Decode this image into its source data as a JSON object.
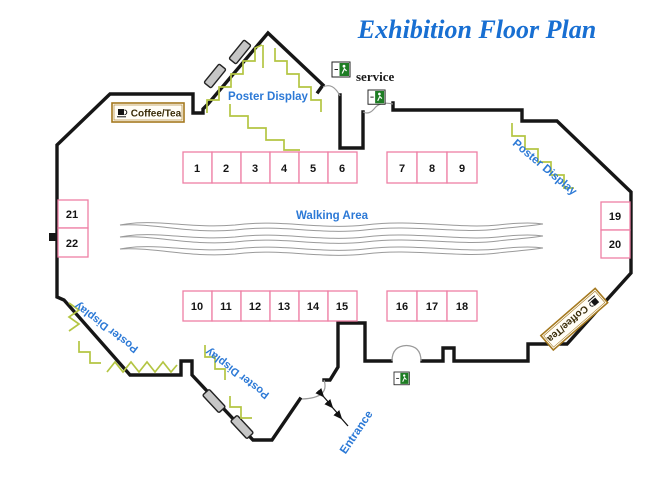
{
  "title": "Exhibition Floor Plan",
  "labels": {
    "coffee_tea_top": "Coffee/Tea",
    "coffee_tea_right": "Coffee/Tea",
    "poster_display_top": "Poster Display",
    "poster_display_right": "Poster Display",
    "poster_display_bottom_left": "Poster Display",
    "poster_display_bottom_center": "Poster Display",
    "service": "service",
    "walking_area": "Walking Area",
    "entrance": "Entrance"
  },
  "booths": {
    "top_row_left": [
      "1",
      "2",
      "3",
      "4",
      "5",
      "6"
    ],
    "top_row_right": [
      "7",
      "8",
      "9"
    ],
    "bottom_row_left": [
      "10",
      "11",
      "12",
      "13",
      "14",
      "15"
    ],
    "bottom_row_right": [
      "16",
      "17",
      "18"
    ],
    "right_wall": [
      "19",
      "20"
    ],
    "left_wall": [
      "21",
      "22"
    ]
  },
  "colors": {
    "wall": "#161616",
    "booth_border": "#ee7fa5",
    "label_blue": "#2c79d6",
    "title_blue": "#186fd2",
    "zigzag_green": "#b4c543",
    "coffee_border": "#a5791f",
    "exit_green": "#1e7d24",
    "door_gray": "#c6c6c6",
    "arc_gray": "#9a9a9a"
  }
}
